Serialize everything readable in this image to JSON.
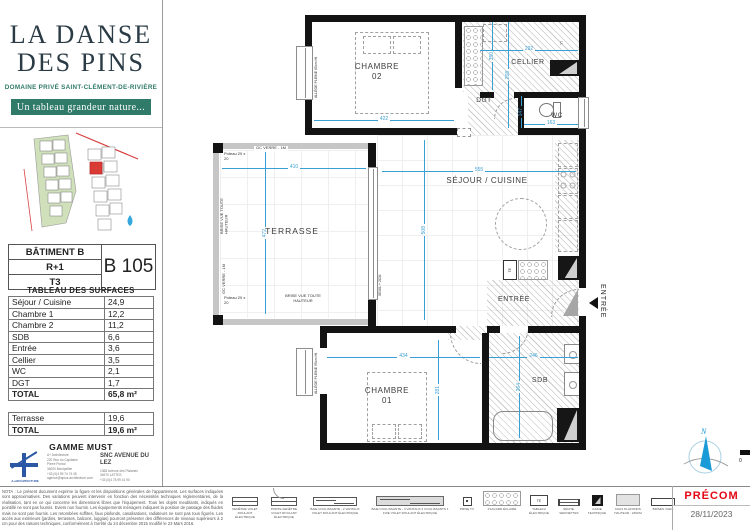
{
  "branding": {
    "title1": "LA DANSE",
    "title2": "DES PINS",
    "subtitle": "DOMAINE PRIVÉ SAINT-CLÉMENT-DE-RIVIÈRE",
    "tagline": "Un tableau grandeur nature..."
  },
  "unit": {
    "building": "BÂTIMENT B",
    "floor": "R+1",
    "type": "T3",
    "code": "B 105"
  },
  "surfaces": {
    "title": "TABLEAU DES SURFACES",
    "rows": [
      {
        "label": "Séjour / Cuisine",
        "value": "24,9"
      },
      {
        "label": "Chambre 1",
        "value": "12,2"
      },
      {
        "label": "Chambre 2",
        "value": "11,2"
      },
      {
        "label": "SDB",
        "value": "6,6"
      },
      {
        "label": "Entrée",
        "value": "3,6"
      },
      {
        "label": "Cellier",
        "value": "3,5"
      },
      {
        "label": "WC",
        "value": "2,1"
      },
      {
        "label": "DGT",
        "value": "1,7"
      }
    ],
    "total_label": "TOTAL",
    "total_value": "65,8 m²",
    "terrace_rows": [
      {
        "label": "Terrasse",
        "value": "19,6"
      }
    ],
    "terrace_total_label": "TOTAL",
    "terrace_total_value": "19,6 m²"
  },
  "gamme": "GAMME MUST",
  "architect": {
    "name": "A+ARCHITECTURE",
    "lines": [
      "A+ Architecture",
      "220 Rue du Capitaine",
      "Pierre Pontal",
      "34000 Montpellier",
      "+33 (0)4 99 74 74 45",
      "agence@aplus-architecture.com"
    ]
  },
  "promoter": {
    "name": "SNC AVENUE DU LEZ",
    "lines": [
      "1368 Avenue des Platanes",
      "34970 LATTES",
      "+33 (0)4 78 99 41 90"
    ]
  },
  "nota": "NOTA : Le présent document exprime la figure et les dispositions générales de l'appartement. Les surfaces indiquées sont approximatives. Des variations peuvent intervenir en fonction des nécessités techniques réglementaires, de la réalisation, tant en ce qui concerne les dimensions libres que l'équipement. Tous les objets meublants, indiqués en pointillé ne sont pas fournis. Eviers non fournis. Les équipements ménagers indiquent la position de passage des fluides mais ne sont pas fournis. Les retombées soffites, faux plafonds, canalisations, radiateurs ne sont pas tous figurés. Les accès aux extérieurs (jardins, terrasses, balcons, loggias) pourront présenter des différences de niveaux supérieurs à 2 cm pour des raisons techniques, conformément à l'arrêté du 24 décembre 2015 modifié le 23 Mars 2016.",
  "plan": {
    "rooms": {
      "chambre02_l1": "CHAMBRE",
      "chambre02_l2": "02",
      "cellier": "CELLIER",
      "dgt": "DGT",
      "wc": "WC",
      "sejour": "SÉJOUR / CUISINE",
      "terrasse": "TERRASSE",
      "entree": "ENTRÉE",
      "chambre01_l1": "CHAMBRE",
      "chambre01_l2": "01",
      "sdb": "SDB"
    },
    "dims": {
      "ch2_w": "422",
      "ch2_h": "268",
      "cellier_w": "292",
      "cellier_h": "350",
      "wc_w": "163",
      "wc_h": "147",
      "sejour_w": "555",
      "sejour_h": "508",
      "terr_w": "410",
      "terr_h": "472",
      "ch1_w": "434",
      "ch1_h": "281",
      "sdb_w": "246",
      "sdb_h": "264"
    },
    "annotations": {
      "gc_verre": "GC VERRE - 1M",
      "poteau": "Poteau 20 x 20",
      "brise_vue": "BRISE VUE TOUTE HAUTEUR",
      "allege_ch2": "ALLÈGE PLEINE 65cm Ht",
      "allege_ch1": "ALLÈGE PLEINE 95cm Ht",
      "seuil": "SEUIL + 2CM",
      "te": "TE",
      "f": "F",
      "entree_direction": "ENTRÉE"
    },
    "scalebar": {
      "ratio": "1:50",
      "t0": "0",
      "t1": "1",
      "t2": "2M"
    },
    "compass": "N"
  },
  "legend": {
    "te": "TE",
    "items": [
      {
        "icon": "window",
        "label": "FENÊTRE VOLET ROULANT ÉLECTRIQUE"
      },
      {
        "icon": "door-window",
        "label": "PORTE-FENÊTRE VOLET ROULANT ÉLECTRIQUE"
      },
      {
        "icon": "sliding-bay-2",
        "label": "BAIE COULISSANTE - 2 VANTAUX VOLET ROULANT ÉLECTRIQUE"
      },
      {
        "icon": "sliding-bay-3",
        "label": "BAIE COULISSANTE - 3 VANTAUX 2 COULISSANTS 1 FIXE VOLET ROULANT ÉLECTRIQUE"
      },
      {
        "icon": "tv-socket",
        "label": "PRISE TV"
      },
      {
        "icon": "lighted-closet",
        "label": "PLACARD ÉCLAIRÉ"
      },
      {
        "icon": "electrical-panel",
        "label": "TABLEAU ÉLECTRIQUE"
      },
      {
        "icon": "towel-dryer",
        "label": "SÈCHE-SERVIETTES"
      },
      {
        "icon": "technical-duct",
        "label": "GAINE TECHNIQUE"
      },
      {
        "icon": "false-ceiling",
        "label": "FAUX PLAFONDS HAUTEUR : 230CM"
      },
      {
        "icon": "privacy-screen",
        "label": "BRISES VUES"
      }
    ]
  },
  "footer": {
    "precom": "PRÉCOM",
    "date": "28/11/2023"
  }
}
